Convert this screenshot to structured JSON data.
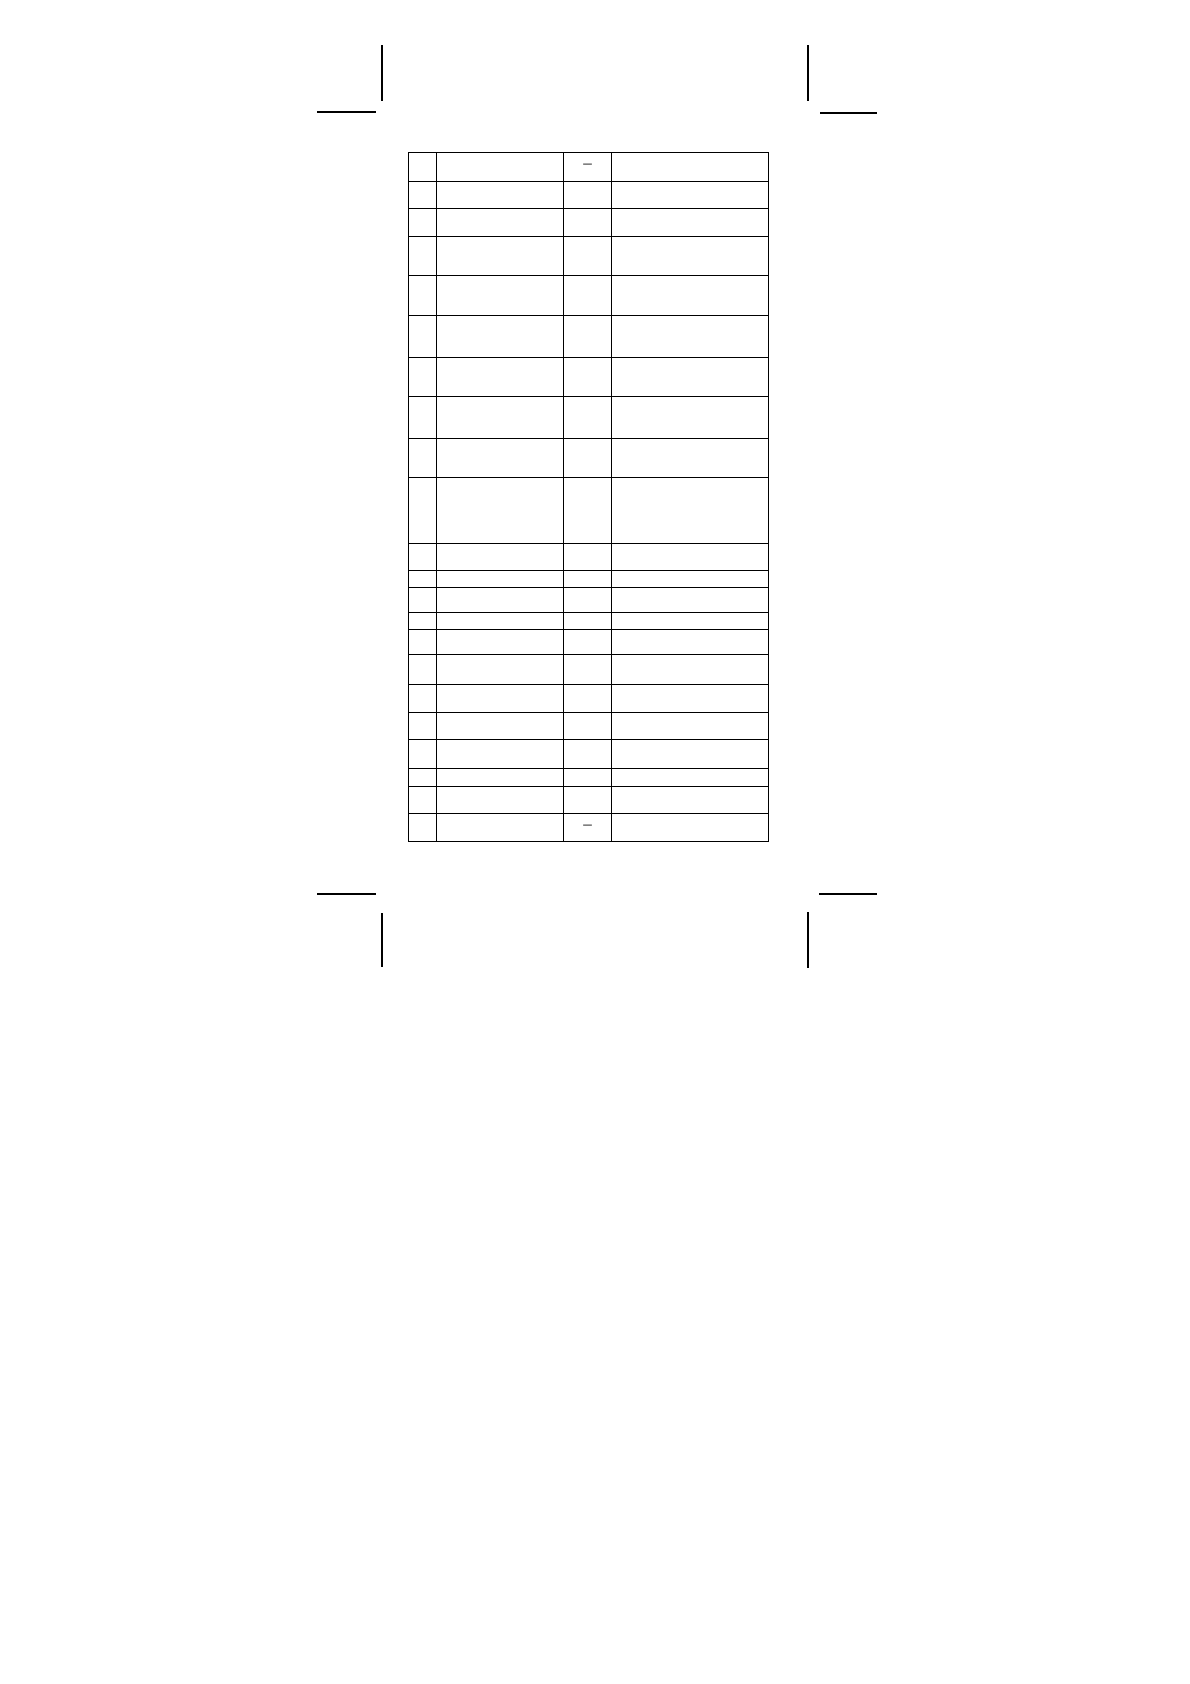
{
  "page": {
    "background_color": "#ffffff"
  },
  "crop_marks": {
    "color": "#000000",
    "count": 4
  },
  "table": {
    "border_color": "#000000",
    "column_count": 4,
    "rows": [
      {
        "cells": [
          "",
          "",
          "–",
          ""
        ]
      },
      {
        "cells": [
          "",
          "",
          "",
          ""
        ]
      },
      {
        "cells": [
          "",
          "",
          "",
          ""
        ]
      },
      {
        "cells": [
          "",
          "",
          "",
          ""
        ]
      },
      {
        "cells": [
          "",
          "",
          "",
          ""
        ]
      },
      {
        "cells": [
          "",
          "",
          "",
          ""
        ]
      },
      {
        "cells": [
          "",
          "",
          "",
          ""
        ]
      },
      {
        "cells": [
          "",
          "",
          "",
          ""
        ]
      },
      {
        "cells": [
          "",
          "",
          "",
          ""
        ]
      },
      {
        "cells": [
          "",
          "",
          "",
          ""
        ]
      },
      {
        "cells": [
          "",
          "",
          "",
          ""
        ]
      },
      {
        "cells": [
          "",
          "",
          "",
          ""
        ]
      },
      {
        "cells": [
          "",
          "",
          "",
          ""
        ]
      },
      {
        "cells": [
          "",
          "",
          "",
          ""
        ]
      },
      {
        "cells": [
          "",
          "",
          "",
          ""
        ]
      },
      {
        "cells": [
          "",
          "",
          "",
          ""
        ]
      },
      {
        "cells": [
          "",
          "",
          "",
          ""
        ]
      },
      {
        "cells": [
          "",
          "",
          "",
          ""
        ]
      },
      {
        "cells": [
          "",
          "",
          "",
          ""
        ]
      },
      {
        "cells": [
          "",
          "",
          "",
          ""
        ]
      },
      {
        "cells": [
          "",
          "",
          "",
          ""
        ]
      },
      {
        "cells": [
          "",
          "",
          "–",
          ""
        ]
      }
    ]
  }
}
